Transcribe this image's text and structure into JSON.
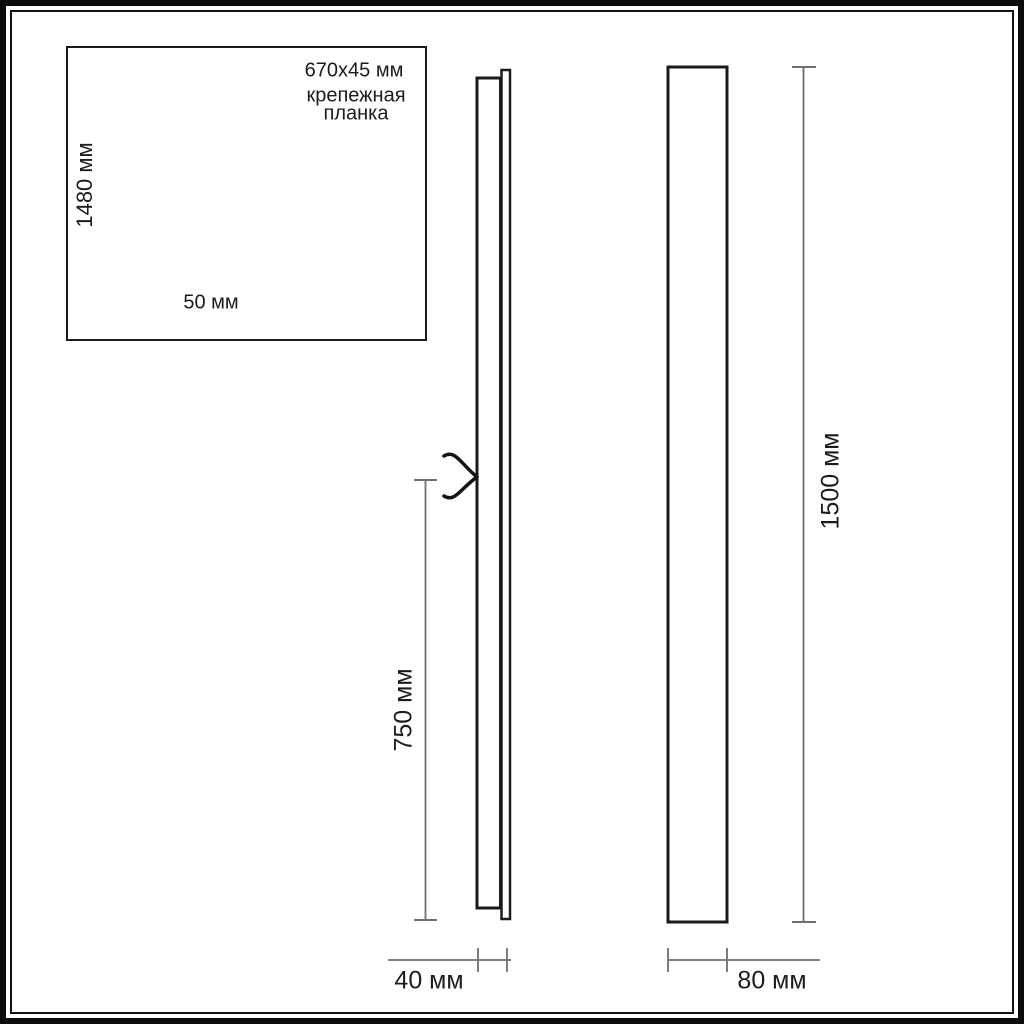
{
  "inset_detail": {
    "height_dimension": "1480 мм",
    "width_dimension": "50 мм",
    "mounting_plate_size": "670x45 мм",
    "mounting_plate_label_line1": "крепежная",
    "mounting_plate_label_line2": "планка"
  },
  "side_view": {
    "mount_center_dimension": "750 мм",
    "depth_dimension": "40 мм"
  },
  "front_view": {
    "height_dimension": "1500 мм",
    "width_dimension": "80 мм"
  },
  "colors": {
    "drawing_line": "#1c1c1c",
    "dimension_line": "#6f6f6f",
    "background": "#ffffff"
  }
}
